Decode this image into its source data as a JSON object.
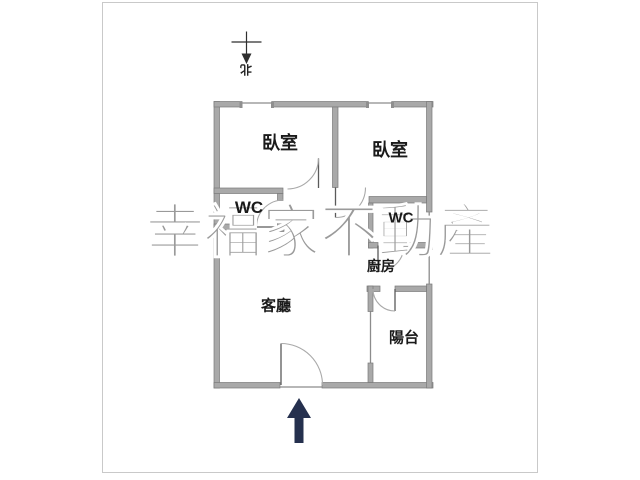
{
  "watermark": {
    "text": "幸福家不動產"
  },
  "north_indicator": {
    "label": "北"
  },
  "rooms": {
    "bedroom1": {
      "label": "臥室"
    },
    "bedroom2": {
      "label": "臥室"
    },
    "wc1": {
      "label": "WC"
    },
    "wc2": {
      "label": "WC"
    },
    "kitchen": {
      "label": "廚房"
    },
    "living_room": {
      "label": "客廳"
    },
    "balcony": {
      "label": "陽台"
    }
  },
  "colors": {
    "wall": "#a9a9a9",
    "wall_edge": "#7a7a7a",
    "thin_line": "#8c8c8c",
    "arc": "#a9a9a9",
    "leaf": "#5a5a5a",
    "watermark": "#9a9a9a",
    "frame_border": "#c9c9c9",
    "label_text": "#1a1a1a",
    "entrance_arrow": "#25304e"
  }
}
